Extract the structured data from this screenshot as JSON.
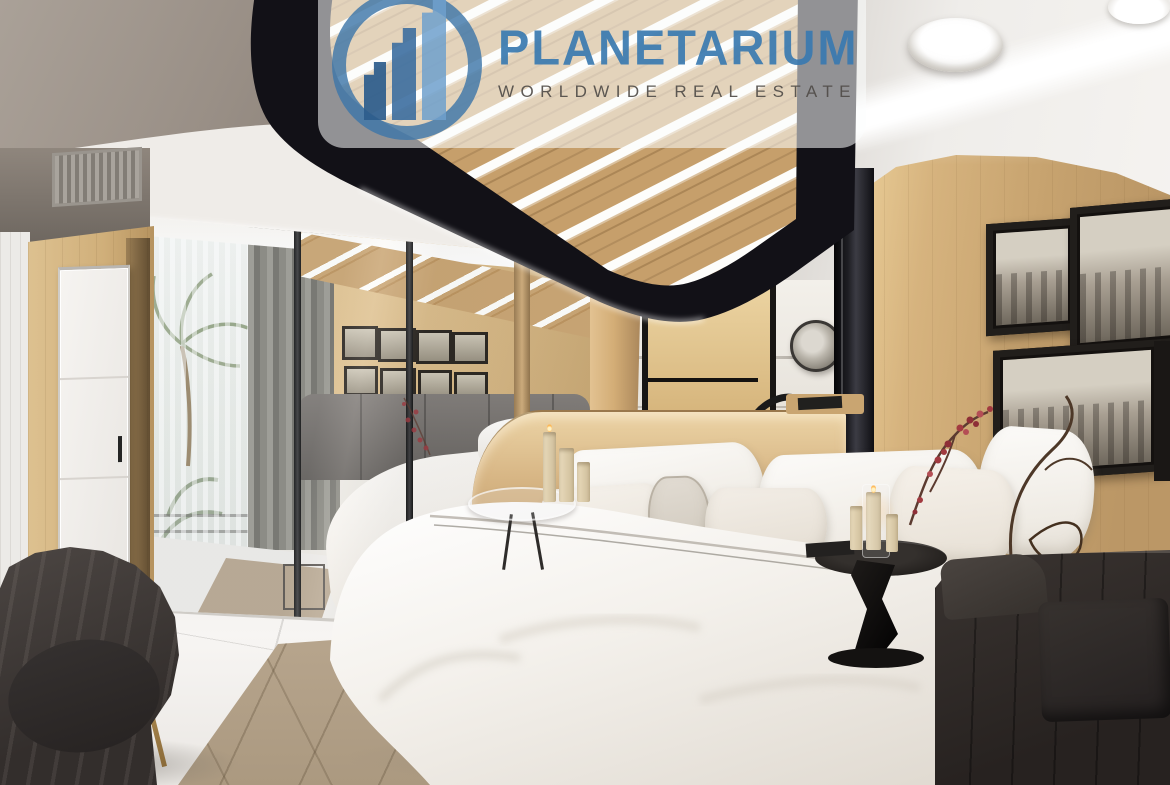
{
  "watermark": {
    "brand": "PLANETARIUM",
    "tagline": "WORLDWIDE REAL ESTATE",
    "logo_icon": "growth-buildings-circle-logo",
    "colors": {
      "brand_blue": "#3a7ab0",
      "logo_ring_blue": "#3e76a8",
      "tagline_gray": "#504c48",
      "panel_white": "rgba(255,255,255,0.55)"
    }
  },
  "scene": {
    "description": "3D rendered luxury bedroom: white double bed with pillows on a beige geometric rug, mirrored wardrobe reflecting balcony palms and gallery wall, black ceiling canopy with wood slats and LED strips, curved wood wall with black-framed monochrome photos, dark armchair and sofa on white marble floor",
    "palette": {
      "wood": "#d2b284",
      "wood_dark": "#b99665",
      "ceiling_taupe": "#9d958c",
      "canopy_black": "#141318",
      "marble": "#f3f1ee",
      "bedding_white": "#f6f3ef",
      "rug_beige": "#b3a18a",
      "chair_charcoal": "#3b3533",
      "sofa_charcoal": "#2f2a27",
      "curtain_gray": "#83827f",
      "blossom_red": "#a23a40"
    }
  }
}
